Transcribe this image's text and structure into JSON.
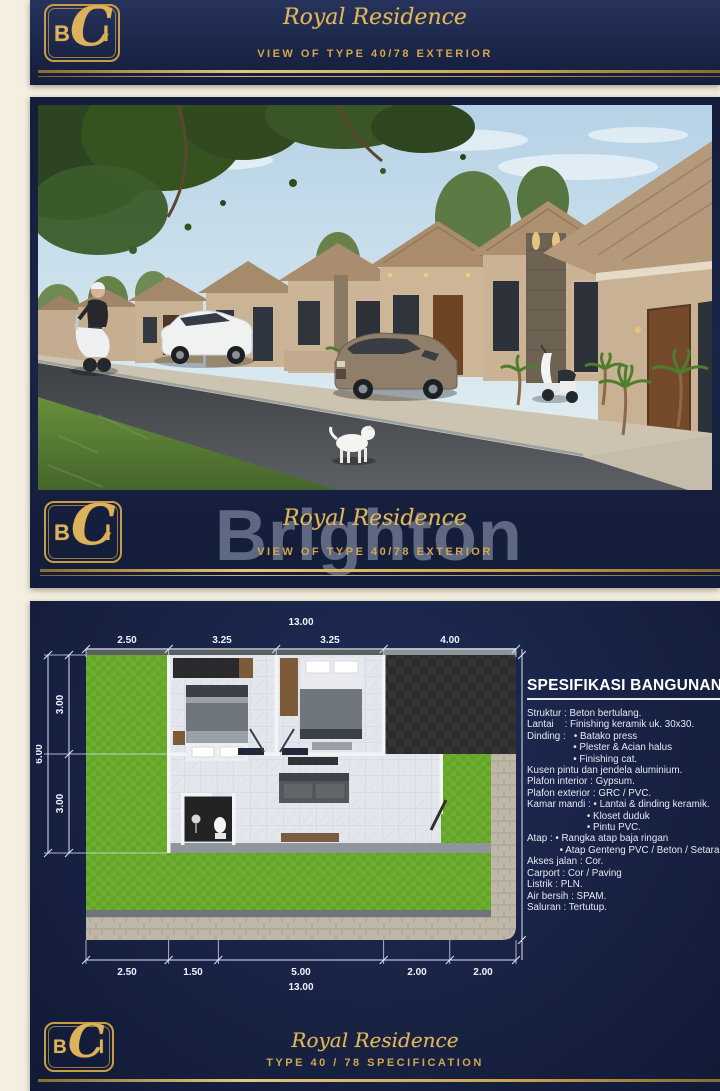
{
  "brand": {
    "b": "B",
    "c": "C",
    "i": "I"
  },
  "top_banner": {
    "title": "Royal Residence",
    "subtitle": "VIEW OF TYPE 40/78 EXTERIOR"
  },
  "exterior": {
    "title": "Royal Residence",
    "subtitle": "VIEW OF TYPE 40/78 EXTERIOR",
    "watermark": "Brighton"
  },
  "plan": {
    "spec_title": "SPESIFIKASI BANGUNAN",
    "spec_lines": [
      "Struktur : Beton bertulang.",
      "Lantai    : Finishing keramik uk. 30x30.",
      "Dinding :   • Batako press",
      "                 • Plester & Acian halus",
      "                 • Finishing cat.",
      "Kusen pintu dan jendela aluminium.",
      "Plafon interior : Gypsum.",
      "Plafon exterior : GRC / PVC.",
      "Kamar mandi : • Lantai & dinding keramik.",
      "                      • Kloset duduk",
      "                      • Pintu PVC.",
      "Atap : • Rangka atap baja ringan",
      "            • Atap Genteng PVC / Beton / Setara",
      "Akses jalan : Cor.",
      "Carport : Cor / Paving",
      "Listrik : PLN.",
      "Air bersih : SPAM.",
      "Saluran : Tertutup."
    ],
    "dims": {
      "top_total": "13.00",
      "top_segments": [
        "2.50",
        "3.25",
        "3.25",
        "4.00"
      ],
      "bottom_segments": [
        "2.50",
        "1.50",
        "5.00",
        "2.00",
        "2.00"
      ],
      "bottom_total": "13.00",
      "left_total": "6.00",
      "left_segments": [
        "3.00",
        "3.00"
      ]
    }
  },
  "bottom_banner": {
    "title": "Royal Residence",
    "subtitle": "TYPE 40 / 78 SPECIFICATION"
  },
  "colors": {
    "navy": "#18234a",
    "gold": "#d2a951",
    "cream": "#f5efe2",
    "grass": "#6cae2d",
    "roof_tan": "#ab8f6e",
    "asphalt": "#4a4d52",
    "tile": "#e3e6ed",
    "watermark_gray": "#9aa6bd"
  }
}
